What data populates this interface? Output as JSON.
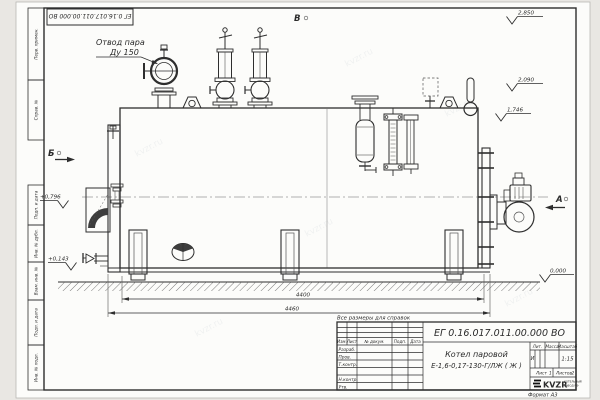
{
  "frame": {
    "top_stamp": "ЕГ 0.16.017.011.00.000 ВО",
    "margin_labels": [
      "Перв. примен.",
      "Справ. №",
      "Подп. и дата",
      "Инв. № дубл.",
      "Взам. инв. №",
      "Подп. и дата",
      "Инв. № подл."
    ],
    "format_note": "Формат А3"
  },
  "drawing": {
    "labels": {
      "steam_outlet_line1": "Отвод пара",
      "steam_outlet_line2": "Ду 150",
      "view_top": "В",
      "view_left": "Б",
      "view_right": "А"
    },
    "elevations": {
      "right_top": "2,850",
      "right_mid": "2,090",
      "right_low": "1,746",
      "ground": "0,000",
      "left_upper": "+0,796",
      "left_lower": "+0,143"
    },
    "dimensions": {
      "shell_length": "4400",
      "overall_length": "4460"
    },
    "reference_note": "Все размеры для справок",
    "watermark": "kvzr.ru"
  },
  "title_block": {
    "doc_number": "ЕГ 0.16.017.011.00.000  ВО",
    "product_name_line1": "Котел паровой",
    "product_name_line2": "Е-1,6-0,17-130-Г/ЛЖ ( Ж )",
    "headers": {
      "izm": "Изм.",
      "list": "Лист",
      "doc": "№ докум.",
      "sign": "Подп.",
      "date": "Дата",
      "lit": "Лит.",
      "mass": "Масса",
      "scale": "Масштаб"
    },
    "rows": {
      "developed": "Разраб.",
      "checked": "Пров.",
      "tcontrol": "Т.контр.",
      "ncontrol": "Н.контр.",
      "approved": "Утв."
    },
    "lit_value": "И",
    "scale_value": "1:15",
    "sheet_label": "Лист",
    "sheet_value": "1",
    "sheets_label": "Листов",
    "sheets_value": "2",
    "logo_text": "KVZR",
    "logo_caption_line1": "КОТЕЛЬНЫЙ",
    "logo_caption_line2": "ЗАВОД РФ"
  }
}
